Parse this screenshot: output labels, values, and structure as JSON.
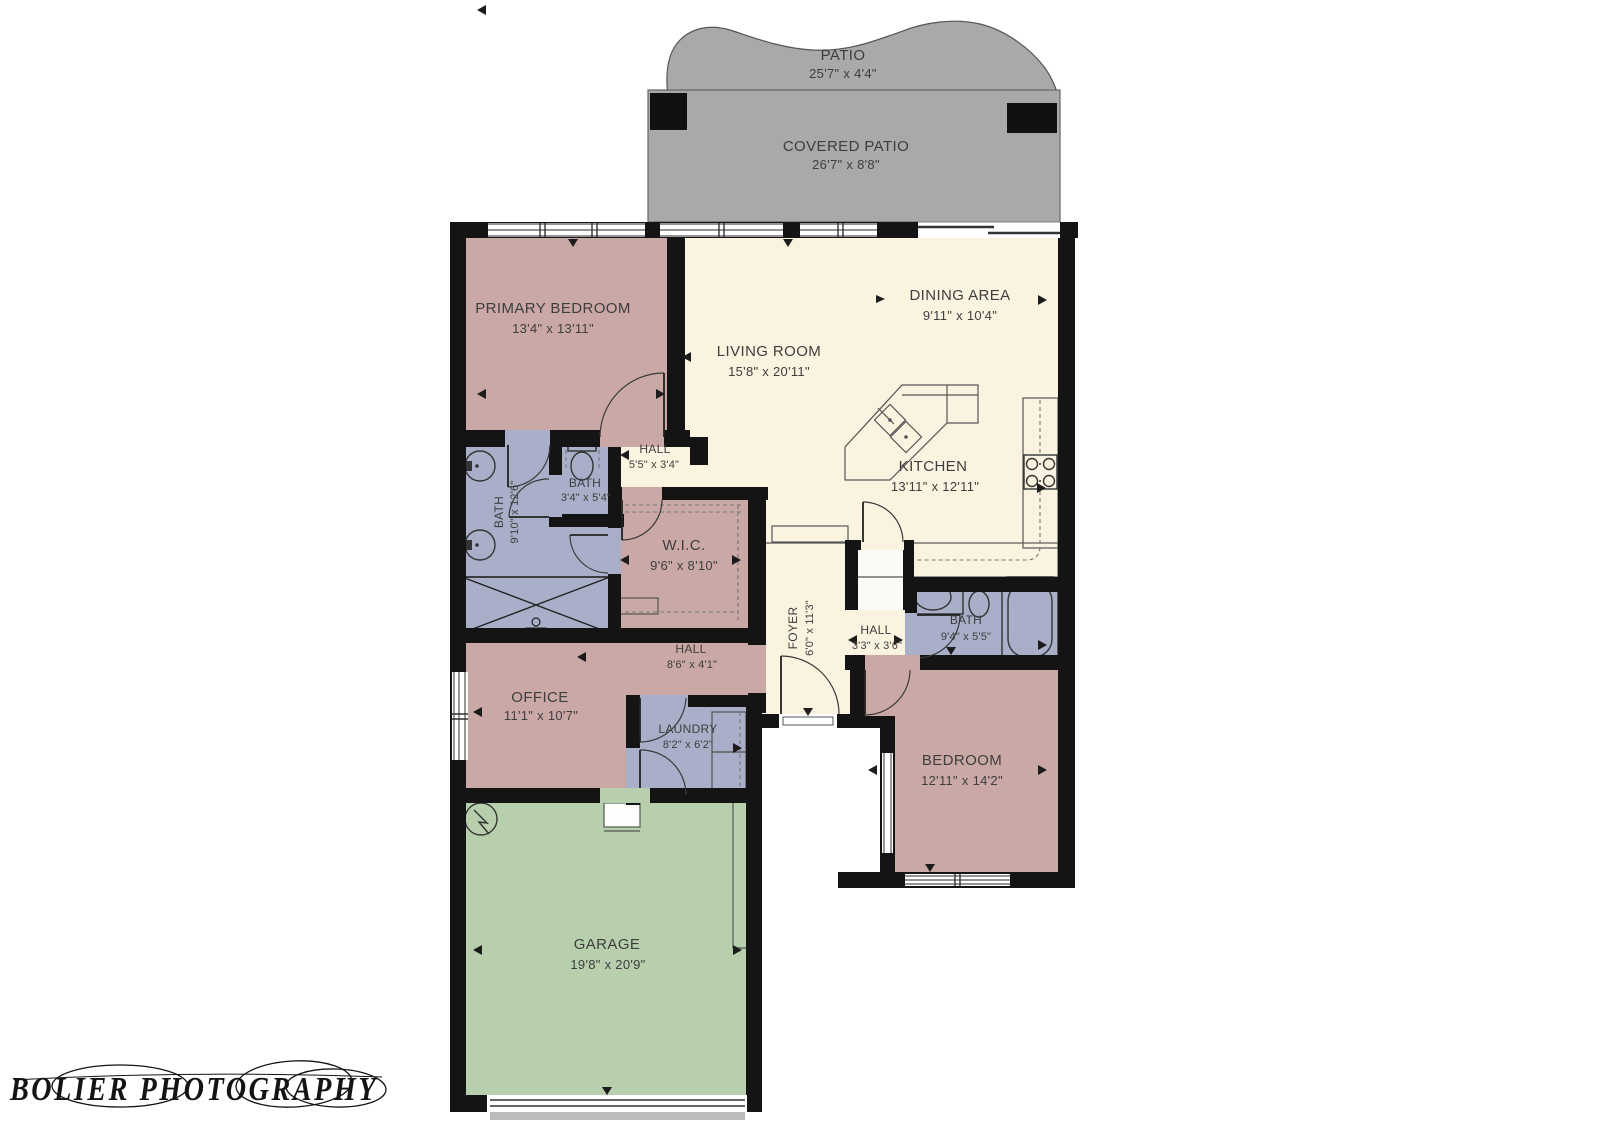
{
  "watermark": "BOLIER PHOTOGRAPHY",
  "colors": {
    "floor": "#FAF3DF",
    "room": "#C9A8A6",
    "bath": "#A9AFC8",
    "garage": "#B7CFAD",
    "patio": "#A9A9A9",
    "wall": "#141414",
    "text": "#3E3E3E"
  },
  "rooms": {
    "patio": {
      "name": "PATIO",
      "dims": "25'7\" x 4'4\""
    },
    "covered_patio": {
      "name": "COVERED PATIO",
      "dims": "26'7\" x 8'8\""
    },
    "primary_bedroom": {
      "name": "PRIMARY BEDROOM",
      "dims": "13'4\" x 13'11\""
    },
    "living_room": {
      "name": "LIVING ROOM",
      "dims": "15'8\" x 20'11\""
    },
    "dining_area": {
      "name": "DINING AREA",
      "dims": "9'11\" x 10'4\""
    },
    "kitchen": {
      "name": "KITCHEN",
      "dims": "13'11\" x 12'11\""
    },
    "hall_upper": {
      "name": "HALL",
      "dims": "5'5\" x 3'4\""
    },
    "bath_half": {
      "name": "BATH",
      "dims": "3'4\" x 5'4\""
    },
    "bath_primary": {
      "name": "BATH",
      "dims": "9'10\" x 12'6\""
    },
    "wic": {
      "name": "W.I.C.",
      "dims": "9'6\" x 8'10\""
    },
    "foyer": {
      "name": "FOYER",
      "dims": "6'0\" x 11'3\""
    },
    "hall_small": {
      "name": "HALL",
      "dims": "3'3\" x 3'6\""
    },
    "bath_guest": {
      "name": "BATH",
      "dims": "9'4\" x 5'5\""
    },
    "hall_office": {
      "name": "HALL",
      "dims": "8'6\" x 4'1\""
    },
    "office": {
      "name": "OFFICE",
      "dims": "11'1\" x 10'7\""
    },
    "laundry": {
      "name": "LAUNDRY",
      "dims": "8'2\" x 6'2\""
    },
    "bedroom": {
      "name": "BEDROOM",
      "dims": "12'11\" x 14'2\""
    },
    "garage": {
      "name": "GARAGE",
      "dims": "19'8\" x 20'9\""
    }
  }
}
